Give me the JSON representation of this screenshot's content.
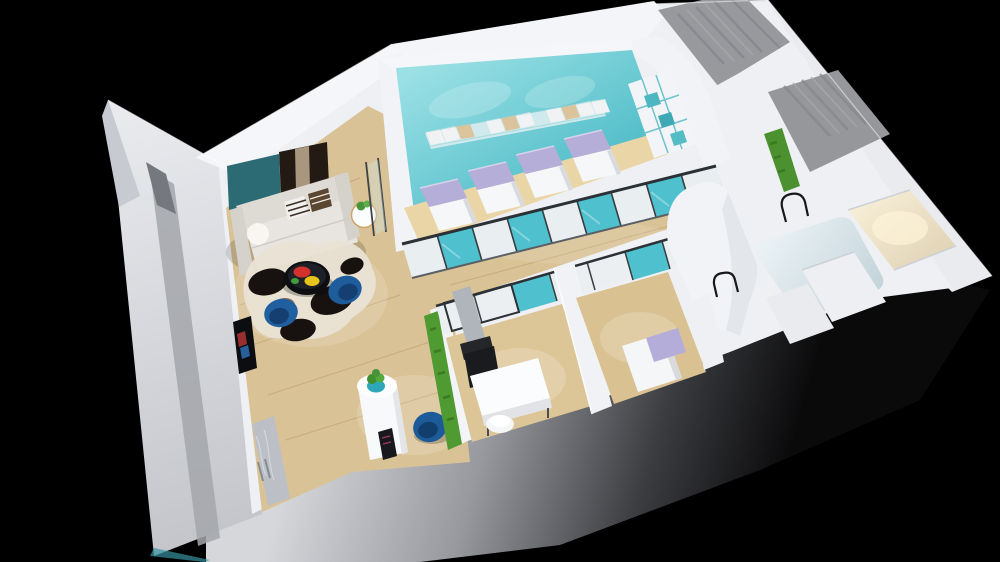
{
  "scene": {
    "kind": "3d-isometric-interior-floorplan-render",
    "view": "top-down three-quarter aerial view on black backdrop",
    "rooms": [
      {
        "name": "lounge-waiting-area",
        "floor": "light-wood",
        "items": [
          "abstract-wall-art",
          "gray-sofa",
          "round-side-table-with-plant",
          "black-round-coffee-table",
          "two-blue-armchairs",
          "cowhide-rug",
          "reception-pedestal-with-plant",
          "blue-tub-chair",
          "wall-tv",
          "marble-entry-glass-door",
          "green-hedge-partition"
        ]
      },
      {
        "name": "spa-treatment-room",
        "floor": "wood-with-teal-feature-wall",
        "items": [
          "four-treatment-beds-lavender-pillows",
          "mosaic-tile-band",
          "white-shelving-teal-cubbies",
          "glass-partition-teal-panels"
        ]
      },
      {
        "name": "consult-room",
        "floor": "light-wood",
        "items": [
          "white-desk",
          "black-office-chair",
          "white-stool",
          "gray-display-panel"
        ]
      },
      {
        "name": "small-treatment-room",
        "floor": "light-wood",
        "items": [
          "white-bed-lavender-pillow"
        ]
      },
      {
        "name": "rounded-corner-room",
        "floor": "pale-blue"
      },
      {
        "name": "warm-lit-corner-room",
        "floor": "warm-beige"
      },
      {
        "name": "gray-plank-rooms-northeast",
        "floor": "gray-wood-planks",
        "items": [
          "green-plant-wall-strip",
          "arched-doorway-outlines"
        ]
      }
    ],
    "palette": {
      "bg": "#000000",
      "wall": "#eef0f3",
      "wall_bright": "#f5f6f9",
      "left_wall": "#dfe1e5",
      "left_wall_stripe": "#a3a6ac",
      "south_light": "#d6d7db",
      "south_dark": "#0a0a0b",
      "wood": "#d9c295",
      "wood_light": "#ead5a6",
      "teal_light": "#9be0e5",
      "teal": "#55bfca",
      "glass_teal": "#4fc0cd",
      "lavender": "#b5aed8",
      "bed_white": "#f6f7f9",
      "sofa_gray": "#dedbd5",
      "art_teal": "#2c6a74",
      "art_dark": "#241a14",
      "chair_blue": "#1e5c9c",
      "chair_blue_dark": "#143f70",
      "table_black": "#0d0e11",
      "plate_red": "#d3312c",
      "plate_yellow": "#e6c41c",
      "plate_green": "#3f9d3a",
      "rug_black": "#17120f",
      "rug_cream": "#e9e2d4",
      "plant_green": "#4f9a31",
      "gray_plank": "#98999d",
      "marble": "#bcc0c6",
      "beige_room": "#efe6d2",
      "pale_floor": "#dce9ed",
      "frame_dark": "#2c3136"
    }
  }
}
